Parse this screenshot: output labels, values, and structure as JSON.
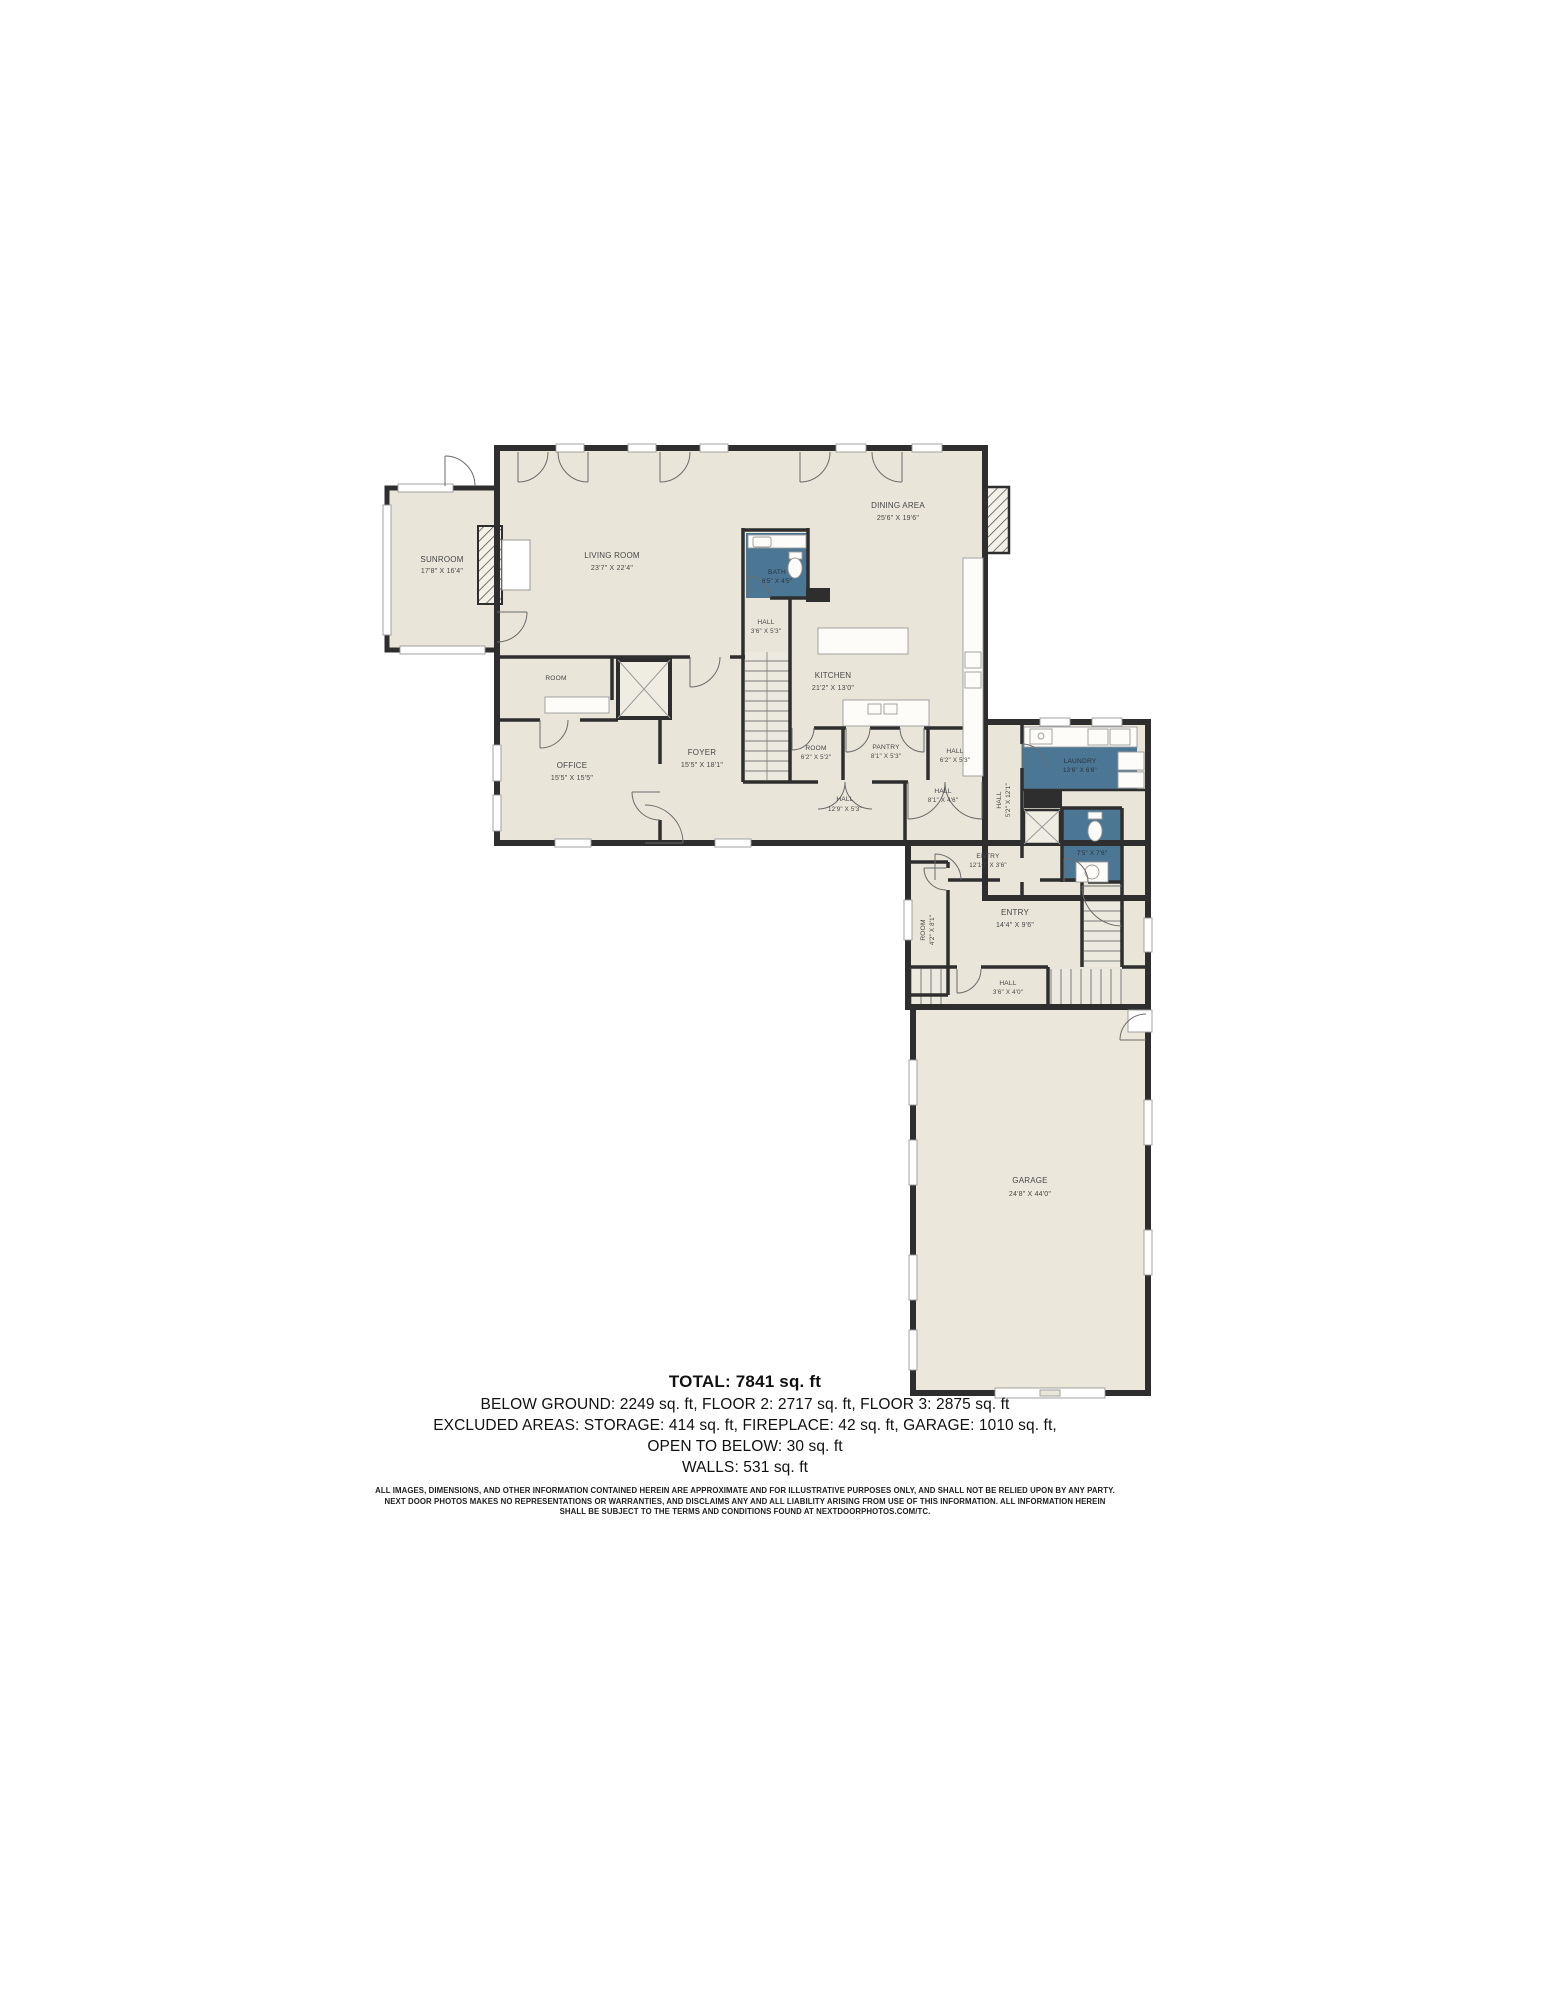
{
  "colors": {
    "floor": "#e9e5d8",
    "wall": "#2e2e2e",
    "wet_room": "#4b7794",
    "fixture_line": "#9a9a9a"
  },
  "rooms": [
    {
      "name": "SUNROOM",
      "dims": "17'8\" X 16'4\""
    },
    {
      "name": "LIVING ROOM",
      "dims": "23'7\" X 22'4\""
    },
    {
      "name": "DINING AREA",
      "dims": "25'6\" X 19'6\""
    },
    {
      "name": "BATH",
      "dims": "6'5\" X 4'5\""
    },
    {
      "name": "HALL",
      "dims": "3'6\" X 5'3\""
    },
    {
      "name": "KITCHEN",
      "dims": "21'2\" X 13'0\""
    },
    {
      "name": "ROOM",
      "dims": ""
    },
    {
      "name": "OFFICE",
      "dims": "15'5\" X 15'5\""
    },
    {
      "name": "FOYER",
      "dims": "15'5\" X 18'1\""
    },
    {
      "name": "ROOM",
      "dims": "6'2\" X 5'2\""
    },
    {
      "name": "PANTRY",
      "dims": "8'1\" X 5'3\""
    },
    {
      "name": "HALL",
      "dims": "6'2\" X 5'3\""
    },
    {
      "name": "HALL",
      "dims": "12'9\" X 5'3\""
    },
    {
      "name": "HALL",
      "dims": "8'1\" X 4'6\""
    },
    {
      "name": "HALL",
      "dims": "5'2\" X 12'1\""
    },
    {
      "name": "LAUNDRY",
      "dims": "13'6\" X 6'6\""
    },
    {
      "name": "BATH",
      "dims": "7'5\" X 7'6\""
    },
    {
      "name": "ENTRY",
      "dims": "12'10\" X 3'6\""
    },
    {
      "name": "ENTRY",
      "dims": "14'4\" X 9'6\""
    },
    {
      "name": "ROOM",
      "dims": "4'2\" X 8'1\""
    },
    {
      "name": "HALL",
      "dims": "3'6\" X 4'0\""
    },
    {
      "name": "GARAGE",
      "dims": "24'8\" X 44'0\""
    }
  ],
  "footer": {
    "total": "TOTAL: 7841 sq. ft",
    "line1": "BELOW GROUND: 2249 sq. ft, FLOOR 2: 2717 sq. ft, FLOOR 3: 2875 sq. ft",
    "line2": "EXCLUDED AREAS: STORAGE: 414 sq. ft, FIREPLACE: 42 sq. ft, GARAGE: 1010 sq. ft,",
    "line3": "OPEN TO BELOW: 30 sq. ft",
    "line4": "WALLS: 531 sq. ft",
    "disclaimer1": "ALL IMAGES, DIMENSIONS, AND OTHER INFORMATION CONTAINED HEREIN ARE APPROXIMATE AND FOR ILLUSTRATIVE PURPOSES ONLY, AND SHALL NOT BE RELIED UPON BY ANY PARTY.",
    "disclaimer2": "NEXT DOOR PHOTOS MAKES NO REPRESENTATIONS OR WARRANTIES, AND DISCLAIMS ANY AND ALL LIABILITY ARISING FROM USE OF THIS INFORMATION. ALL INFORMATION HEREIN",
    "disclaimer3": "SHALL BE SUBJECT TO THE TERMS AND CONDITIONS FOUND AT NEXTDOORPHOTOS.COM/TC."
  }
}
